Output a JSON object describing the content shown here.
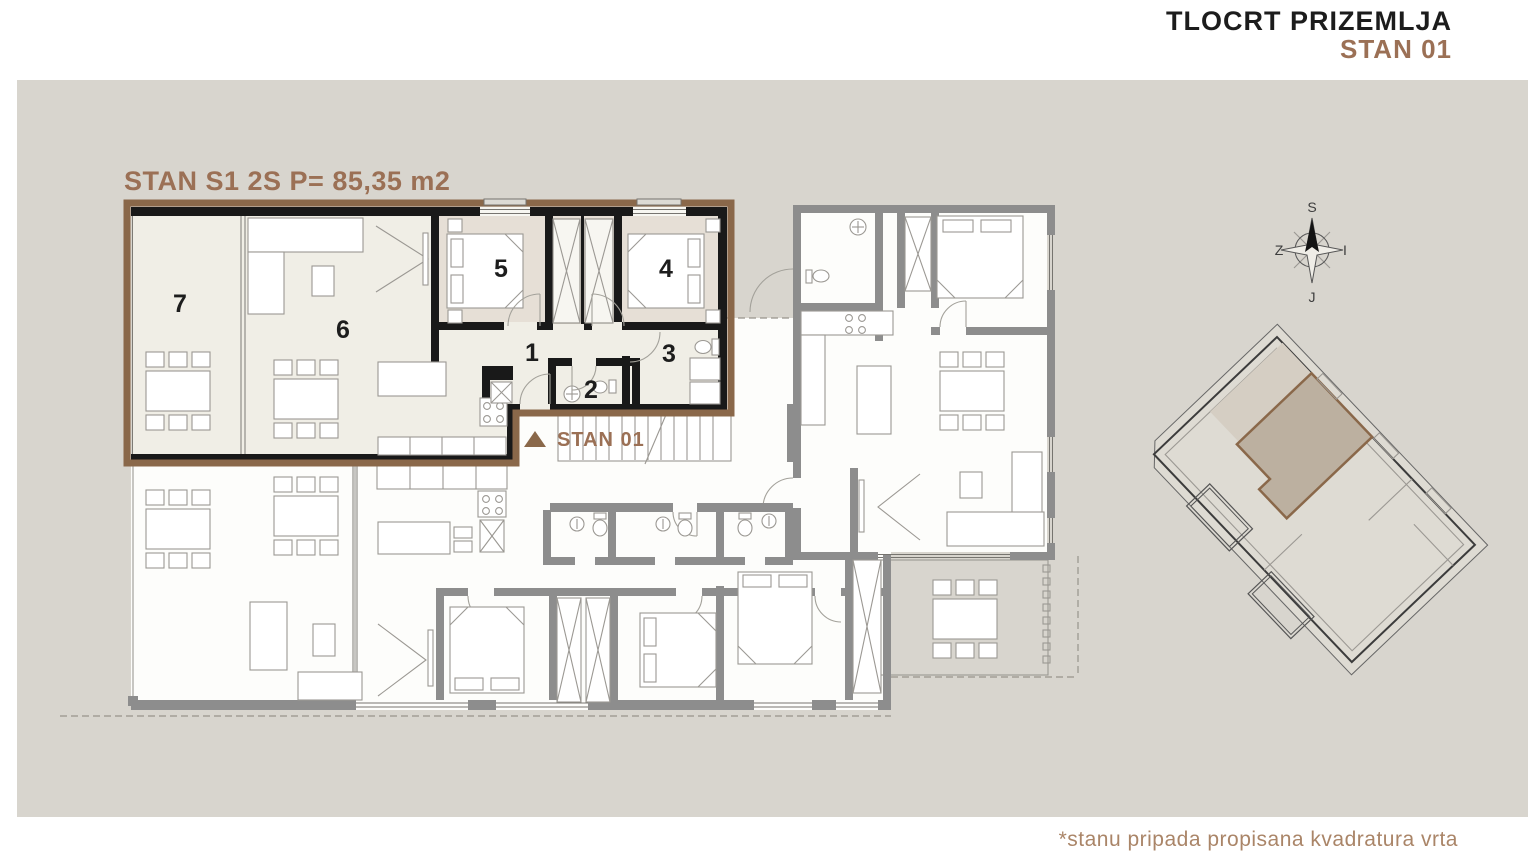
{
  "header": {
    "title": "TLOCRT PRIZEMLJA",
    "subtitle": "STAN 01"
  },
  "plan": {
    "apartment_label": "STAN S1 2S P= 85,35 m2",
    "marker_label": "STAN 01",
    "rooms": [
      "1",
      "2",
      "3",
      "4",
      "5",
      "6",
      "7"
    ]
  },
  "compass": {
    "north": "S",
    "east": "I",
    "south": "J",
    "west": "Z"
  },
  "footnote": "*stanu pripada propisana kvadratura vrta",
  "colors": {
    "background": "#d8d5ce",
    "accent_brown": "#8a684a",
    "heading_brown": "#9b7055",
    "footnote_brown": "#aa8568",
    "wall_black": "#191919",
    "wall_gray": "#8d8d8d",
    "floor_cream": "#f0eee6",
    "floor_beige": "#e6dfd6"
  }
}
